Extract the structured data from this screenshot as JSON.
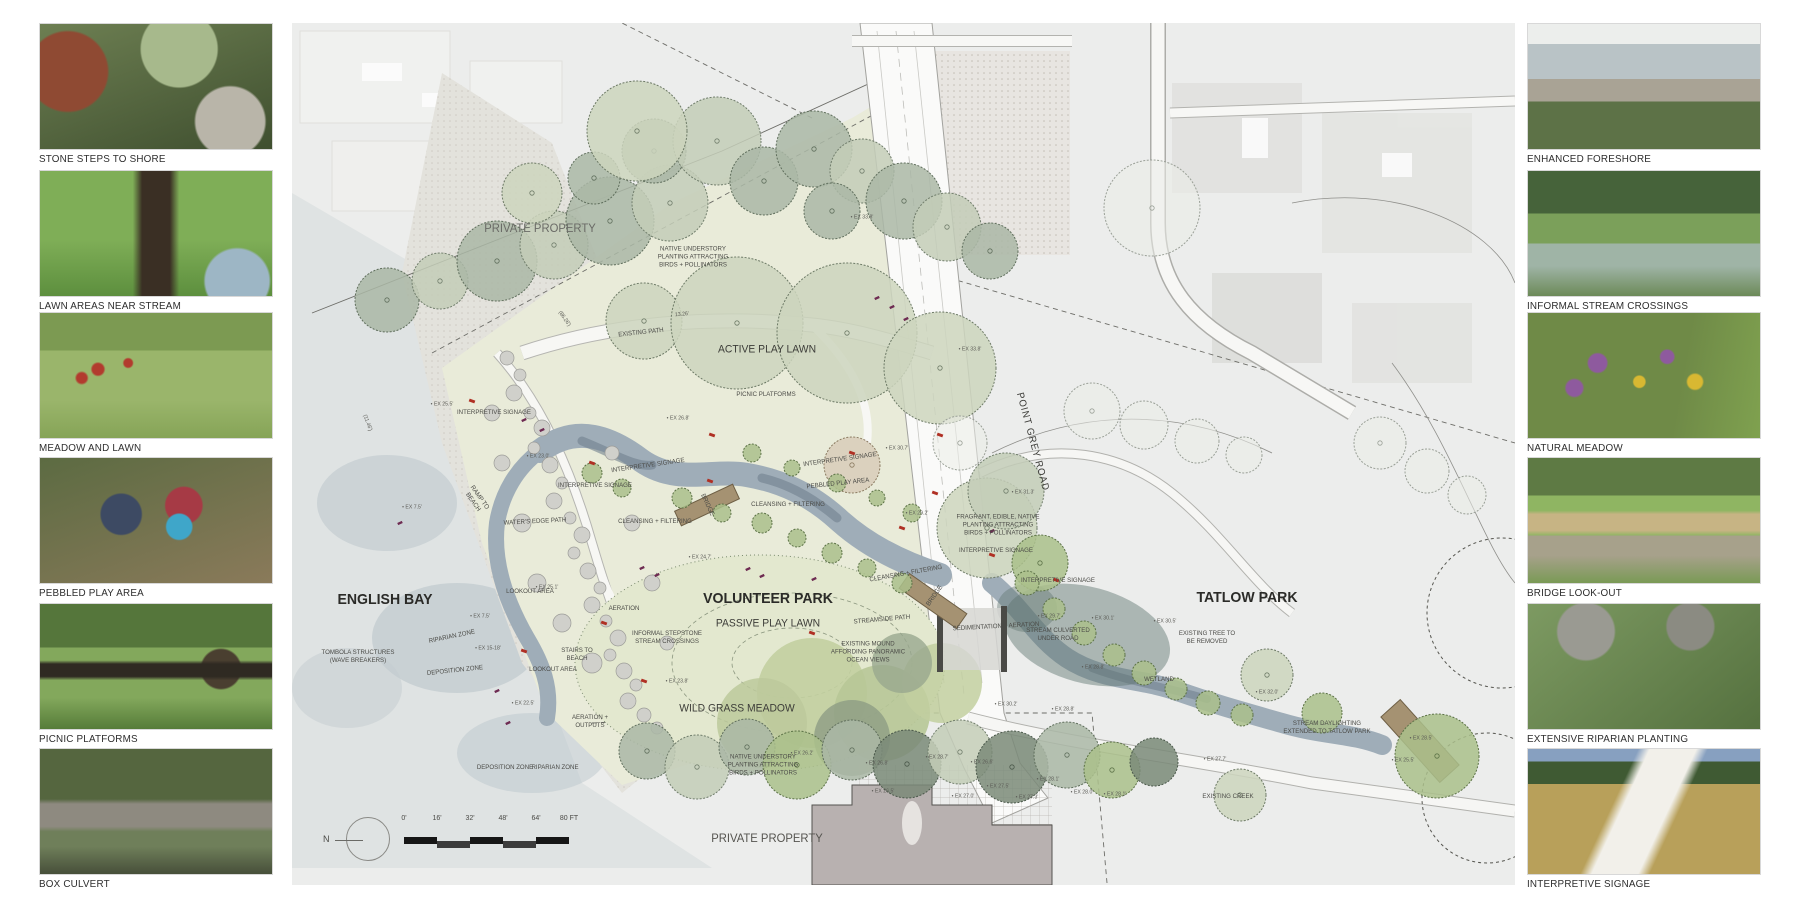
{
  "board_title": "Volunteer Park + Tatlow Park landscape plan board",
  "left_photos": [
    {
      "caption": "STONE STEPS TO SHORE"
    },
    {
      "caption": "LAWN AREAS NEAR STREAM"
    },
    {
      "caption": "MEADOW AND LAWN"
    },
    {
      "caption": "PEBBLED PLAY AREA"
    },
    {
      "caption": "PICNIC PLATFORMS"
    },
    {
      "caption": "BOX CULVERT"
    }
  ],
  "right_photos": [
    {
      "caption": "ENHANCED FORESHORE"
    },
    {
      "caption": "INFORMAL STREAM CROSSINGS"
    },
    {
      "caption": "NATURAL MEADOW"
    },
    {
      "caption": "BRIDGE LOOK-OUT"
    },
    {
      "caption": "EXTENSIVE RIPARIAN PLANTING"
    },
    {
      "caption": "INTERPRETIVE SIGNAGE"
    }
  ],
  "plan": {
    "scale": {
      "north_label": "N",
      "ticks": [
        "0'",
        "16'",
        "32'",
        "48'",
        "64'",
        "80 FT"
      ]
    },
    "region_labels": [
      {
        "t": "ENGLISH BAY",
        "x": 93,
        "y": 577,
        "s": 15,
        "w": 700,
        "c": "#2b2b28"
      },
      {
        "t": "VOLUNTEER PARK",
        "x": 476,
        "y": 576,
        "s": 15,
        "w": 700,
        "c": "#2b2b28"
      },
      {
        "t": "TATLOW PARK",
        "x": 955,
        "y": 575,
        "s": 15,
        "w": 700,
        "c": "#2b2b28"
      },
      {
        "t": "PRIVATE PROPERTY",
        "x": 248,
        "y": 205,
        "s": 12,
        "w": 400,
        "c": "#6a6a66"
      },
      {
        "t": "PRIVATE PROPERTY",
        "x": 475,
        "y": 815,
        "s": 12,
        "w": 400,
        "c": "#55544f"
      },
      {
        "t": "ACTIVE PLAY LAWN",
        "x": 475,
        "y": 327,
        "s": 11,
        "w": 400,
        "c": "#3c3c38"
      },
      {
        "t": "PASSIVE PLAY LAWN",
        "x": 476,
        "y": 601,
        "s": 11,
        "w": 400,
        "c": "#3c3c38"
      },
      {
        "t": "WILD GRASS MEADOW",
        "x": 445,
        "y": 686,
        "s": 11,
        "w": 400,
        "c": "#3c3c38"
      },
      {
        "t": "POINT GREY ROAD",
        "x": 740,
        "y": 419,
        "s": 10,
        "w": 400,
        "r": 75,
        "c": "#3c3c38",
        "ls": 1
      },
      {
        "t": "NATIVE UNDERSTORY\nPLANTING ATTRACTING\nBIRDS + POLLINATORS",
        "x": 401,
        "y": 234,
        "s": 6.5
      },
      {
        "t": "NATIVE UNDERSTORY\nPLANTING ATTRACTING\nBIRDS + POLLINATORS",
        "x": 471,
        "y": 742,
        "s": 6.5
      },
      {
        "t": "EXISTING PATH",
        "x": 349,
        "y": 310,
        "s": 6.5,
        "r": -6
      },
      {
        "t": "PICNIC PLATFORMS",
        "x": 474,
        "y": 372,
        "s": 6.5
      },
      {
        "t": "INTERPRETIVE SIGNAGE",
        "x": 202,
        "y": 390,
        "s": 6.5
      },
      {
        "t": "INTERPRETIVE SIGNAGE",
        "x": 303,
        "y": 463,
        "s": 6.5
      },
      {
        "t": "INTERPRETIVE SIGNAGE",
        "x": 356,
        "y": 443,
        "s": 6.5,
        "r": -8
      },
      {
        "t": "INTERPRETIVE SIGNAGE",
        "x": 548,
        "y": 437,
        "s": 6.5,
        "r": -8
      },
      {
        "t": "INTERPRETIVE SIGNAGE",
        "x": 704,
        "y": 528,
        "s": 6.5
      },
      {
        "t": "INTERPRETIVE SIGNAGE",
        "x": 766,
        "y": 558,
        "s": 6.5
      },
      {
        "t": "PEBBLED PLAY AREA",
        "x": 546,
        "y": 461,
        "s": 6.5,
        "r": -6
      },
      {
        "t": "BRIDGE",
        "x": 415,
        "y": 482,
        "s": 6.5,
        "r": 65
      },
      {
        "t": "BRIDGE",
        "x": 643,
        "y": 573,
        "s": 6.5,
        "r": -55
      },
      {
        "t": "CLEANSING + FILTERING",
        "x": 496,
        "y": 482,
        "s": 6.5
      },
      {
        "t": "CLEANSING + FILTERING",
        "x": 363,
        "y": 499,
        "s": 6.5
      },
      {
        "t": "CLEANSING + FILTERING",
        "x": 614,
        "y": 551,
        "s": 6.5,
        "r": -10
      },
      {
        "t": "WATER'S EDGE PATH",
        "x": 243,
        "y": 499,
        "s": 6.5,
        "r": -3
      },
      {
        "t": "RAMP TO\nBEACH",
        "x": 184,
        "y": 477,
        "s": 6.5,
        "r": 55
      },
      {
        "t": "LOOKOUT AREA",
        "x": 238,
        "y": 569,
        "s": 6.5
      },
      {
        "t": "LOOKOUT AREA",
        "x": 261,
        "y": 647,
        "s": 6.5
      },
      {
        "t": "AERATION",
        "x": 332,
        "y": 586,
        "s": 6.5
      },
      {
        "t": "AERATION +\nOUTPUTS",
        "x": 298,
        "y": 699,
        "s": 6.5
      },
      {
        "t": "TOMBOLA STRUCTURES\n(WAVE BREAKERS)",
        "x": 66,
        "y": 634,
        "s": 6.5
      },
      {
        "t": "RIPARIAN ZONE",
        "x": 160,
        "y": 614,
        "s": 6.5,
        "r": -12
      },
      {
        "t": "RIPARIAN ZONE",
        "x": 263,
        "y": 745,
        "s": 6.5
      },
      {
        "t": "DEPOSITION ZONE",
        "x": 163,
        "y": 648,
        "s": 6.5,
        "r": -6
      },
      {
        "t": "DEPOSITION ZONE",
        "x": 213,
        "y": 745,
        "s": 6.5
      },
      {
        "t": "STAIRS TO\nBEACH",
        "x": 285,
        "y": 632,
        "s": 6.5
      },
      {
        "t": "INFORMAL STEPSTONE\nSTREAM CROSSINGS",
        "x": 375,
        "y": 615,
        "s": 6.5
      },
      {
        "t": "STREAMSIDE PATH",
        "x": 590,
        "y": 597,
        "s": 6.5,
        "r": -5
      },
      {
        "t": "EXISTING MOUND\nAFFORDING PANORAMIC\nOCEAN VIEWS",
        "x": 576,
        "y": 629,
        "s": 6.5
      },
      {
        "t": "SEDIMENTATION + AERATION",
        "x": 704,
        "y": 604,
        "s": 6.5,
        "r": -3
      },
      {
        "t": "FRAGRANT, EDIBLE, NATIVE\nPLANTING ATTRACTING\nBIRDS + POLLINATORS",
        "x": 706,
        "y": 502,
        "s": 6.5
      },
      {
        "t": "STREAM CULVERTED\nUNDER ROAD",
        "x": 766,
        "y": 612,
        "s": 6.5
      },
      {
        "t": "WETLAND",
        "x": 867,
        "y": 657,
        "s": 6.5
      },
      {
        "t": "EXISTING TREE TO\nBE REMOVED",
        "x": 915,
        "y": 615,
        "s": 6.5
      },
      {
        "t": "STREAM DAYLIGHTING\nEXTENDED TO TATLOW PARK",
        "x": 1035,
        "y": 705,
        "s": 6.5
      },
      {
        "t": "EXISTING CREEK",
        "x": 936,
        "y": 774,
        "s": 6.5
      }
    ],
    "elevation_labels": [
      {
        "t": "• EX 33.8'",
        "x": 570,
        "y": 195
      },
      {
        "t": "• EX 33.8'",
        "x": 678,
        "y": 327
      },
      {
        "t": "• EX 26.8'",
        "x": 386,
        "y": 396
      },
      {
        "t": "• EX 30.7'",
        "x": 605,
        "y": 426
      },
      {
        "t": "• EX 29.2'",
        "x": 625,
        "y": 491
      },
      {
        "t": "• EX 31.3'",
        "x": 731,
        "y": 470
      },
      {
        "t": "• EX 30.1'",
        "x": 811,
        "y": 596
      },
      {
        "t": "• EX 29.7'",
        "x": 757,
        "y": 594
      },
      {
        "t": "• EX 28.8'",
        "x": 801,
        "y": 645
      },
      {
        "t": "• EX 28.8'",
        "x": 771,
        "y": 687
      },
      {
        "t": "• EX 30.2'",
        "x": 714,
        "y": 682
      },
      {
        "t": "• EX 30.5'",
        "x": 873,
        "y": 599
      },
      {
        "t": "• EX 32.0'",
        "x": 975,
        "y": 670
      },
      {
        "t": "• EX 27.7'",
        "x": 923,
        "y": 737
      },
      {
        "t": "• EX 28.1'",
        "x": 823,
        "y": 772
      },
      {
        "t": "• EX 25.1'",
        "x": 255,
        "y": 565
      },
      {
        "t": "• EX 23.0'",
        "x": 246,
        "y": 434
      },
      {
        "t": "• EX 25.5'",
        "x": 150,
        "y": 382
      },
      {
        "t": "• EX 7.5'",
        "x": 120,
        "y": 485
      },
      {
        "t": "• EX 7.5'",
        "x": 188,
        "y": 594
      },
      {
        "t": "• EX 23.8'",
        "x": 385,
        "y": 659
      },
      {
        "t": "• EX 24.7'",
        "x": 408,
        "y": 535
      },
      {
        "t": "• EX 22.5'",
        "x": 231,
        "y": 681
      },
      {
        "t": "• EX 15-18'",
        "x": 196,
        "y": 626
      },
      {
        "t": "• EX 26.2'",
        "x": 510,
        "y": 731
      },
      {
        "t": "• EX 26.8'",
        "x": 585,
        "y": 741
      },
      {
        "t": "• EX 26.5'",
        "x": 591,
        "y": 769
      },
      {
        "t": "• EX 28.7'",
        "x": 645,
        "y": 735
      },
      {
        "t": "• EX 26.6'",
        "x": 690,
        "y": 740
      },
      {
        "t": "• EX 27.0'",
        "x": 671,
        "y": 774
      },
      {
        "t": "• EX 27.5'",
        "x": 706,
        "y": 764
      },
      {
        "t": "• EX 27.3'",
        "x": 735,
        "y": 775
      },
      {
        "t": "• EX 28.1'",
        "x": 756,
        "y": 757
      },
      {
        "t": "• EX 28.0'",
        "x": 790,
        "y": 770
      },
      {
        "t": "• EX 28.5'",
        "x": 1129,
        "y": 716
      },
      {
        "t": "• EX 25.5'",
        "x": 1111,
        "y": 738
      }
    ],
    "dimension_labels": [
      {
        "t": "(86.26')",
        "x": 272,
        "y": 296,
        "r": 55
      },
      {
        "t": "13.26'",
        "x": 390,
        "y": 292,
        "r": -5
      },
      {
        "t": "(11.46')",
        "x": 75,
        "y": 400,
        "r": 70
      }
    ],
    "trees": [
      [
        95,
        277,
        32,
        "s"
      ],
      [
        148,
        258,
        28,
        "l"
      ],
      [
        205,
        238,
        40,
        "s"
      ],
      [
        262,
        222,
        34,
        "l"
      ],
      [
        318,
        198,
        44,
        "s"
      ],
      [
        378,
        180,
        38,
        "l"
      ],
      [
        302,
        155,
        26,
        "s"
      ],
      [
        362,
        128,
        32,
        "s"
      ],
      [
        425,
        118,
        44,
        "l"
      ],
      [
        472,
        158,
        34,
        "s"
      ],
      [
        522,
        126,
        38,
        "s"
      ],
      [
        570,
        148,
        32,
        "l"
      ],
      [
        612,
        178,
        38,
        "s"
      ],
      [
        655,
        204,
        34,
        "l"
      ],
      [
        698,
        228,
        28,
        "s"
      ],
      [
        540,
        188,
        28,
        "s"
      ],
      [
        345,
        108,
        50,
        "p"
      ],
      [
        240,
        170,
        30,
        "p"
      ],
      [
        352,
        298,
        38,
        "p"
      ],
      [
        445,
        300,
        66,
        "p"
      ],
      [
        555,
        310,
        70,
        "p"
      ],
      [
        648,
        345,
        56,
        "p"
      ],
      [
        668,
        420,
        27,
        "f"
      ],
      [
        860,
        185,
        48,
        "f"
      ],
      [
        800,
        388,
        28,
        "f"
      ],
      [
        852,
        402,
        24,
        "f"
      ],
      [
        905,
        418,
        22,
        "f"
      ],
      [
        952,
        432,
        18,
        "f"
      ],
      [
        1088,
        420,
        26,
        "f"
      ],
      [
        1135,
        448,
        22,
        "f"
      ],
      [
        1175,
        472,
        19,
        "f"
      ],
      [
        695,
        505,
        50,
        "p"
      ],
      [
        714,
        468,
        38,
        "l"
      ],
      [
        748,
        540,
        28,
        "g"
      ],
      [
        975,
        652,
        26,
        "p"
      ],
      [
        948,
        772,
        26,
        "p"
      ],
      [
        1145,
        733,
        42,
        "g"
      ],
      [
        1030,
        690,
        20,
        "g"
      ],
      [
        560,
        442,
        28,
        "b"
      ],
      [
        735,
        560,
        12,
        "g"
      ],
      [
        762,
        586,
        11,
        "g"
      ],
      [
        792,
        610,
        12,
        "g"
      ],
      [
        822,
        632,
        11,
        "g"
      ],
      [
        852,
        650,
        12,
        "g"
      ],
      [
        884,
        666,
        11,
        "g"
      ],
      [
        916,
        680,
        12,
        "g"
      ],
      [
        950,
        692,
        11,
        "g"
      ],
      [
        355,
        728,
        28,
        "s"
      ],
      [
        405,
        744,
        32,
        "l"
      ],
      [
        455,
        724,
        28,
        "s"
      ],
      [
        505,
        742,
        34,
        "g"
      ],
      [
        560,
        727,
        30,
        "s"
      ],
      [
        615,
        741,
        34,
        "d"
      ],
      [
        668,
        729,
        32,
        "l"
      ],
      [
        720,
        744,
        36,
        "d"
      ],
      [
        775,
        732,
        33,
        "s"
      ],
      [
        820,
        747,
        28,
        "g"
      ],
      [
        862,
        739,
        24,
        "d"
      ],
      [
        300,
        450,
        10,
        "g"
      ],
      [
        330,
        465,
        9,
        "g"
      ],
      [
        390,
        475,
        10,
        "g"
      ],
      [
        430,
        490,
        9,
        "g"
      ],
      [
        470,
        500,
        10,
        "g"
      ],
      [
        505,
        515,
        9,
        "g"
      ],
      [
        540,
        530,
        10,
        "g"
      ],
      [
        575,
        545,
        9,
        "g"
      ],
      [
        610,
        560,
        10,
        "g"
      ],
      [
        460,
        430,
        9,
        "g"
      ],
      [
        500,
        445,
        8,
        "g"
      ],
      [
        545,
        460,
        9,
        "g"
      ],
      [
        585,
        475,
        8,
        "g"
      ],
      [
        620,
        490,
        9,
        "g"
      ]
    ],
    "pebbles": [
      [
        215,
        335,
        7
      ],
      [
        228,
        352,
        6
      ],
      [
        222,
        370,
        8
      ],
      [
        238,
        390,
        6
      ],
      [
        250,
        405,
        8
      ],
      [
        242,
        425,
        6
      ],
      [
        258,
        442,
        8
      ],
      [
        270,
        460,
        6
      ],
      [
        262,
        478,
        8
      ],
      [
        278,
        495,
        6
      ],
      [
        290,
        512,
        8
      ],
      [
        282,
        530,
        6
      ],
      [
        296,
        548,
        8
      ],
      [
        308,
        565,
        6
      ],
      [
        300,
        582,
        8
      ],
      [
        314,
        598,
        6
      ],
      [
        326,
        615,
        8
      ],
      [
        318,
        632,
        6
      ],
      [
        332,
        648,
        8
      ],
      [
        344,
        662,
        6
      ],
      [
        336,
        678,
        8
      ],
      [
        352,
        692,
        7
      ],
      [
        365,
        705,
        6
      ],
      [
        300,
        640,
        10
      ],
      [
        270,
        600,
        9
      ],
      [
        245,
        560,
        9
      ],
      [
        230,
        500,
        9
      ],
      [
        210,
        440,
        8
      ],
      [
        200,
        390,
        8
      ],
      [
        320,
        430,
        7
      ],
      [
        340,
        500,
        8
      ],
      [
        360,
        560,
        8
      ],
      [
        375,
        620,
        7
      ]
    ],
    "red_marks": [
      [
        180,
        378
      ],
      [
        420,
        412
      ],
      [
        300,
        440
      ],
      [
        560,
        430
      ],
      [
        643,
        470
      ],
      [
        700,
        532
      ],
      [
        764,
        557
      ],
      [
        312,
        600
      ],
      [
        352,
        658
      ],
      [
        232,
        628
      ],
      [
        418,
        458
      ],
      [
        610,
        505
      ],
      [
        648,
        412
      ],
      [
        520,
        610
      ]
    ],
    "purple_marks": [
      [
        585,
        275
      ],
      [
        600,
        284
      ],
      [
        614,
        296
      ],
      [
        232,
        397
      ],
      [
        250,
        407
      ],
      [
        456,
        546
      ],
      [
        470,
        553
      ],
      [
        108,
        500
      ],
      [
        216,
        700
      ],
      [
        522,
        556
      ],
      [
        700,
        508
      ],
      [
        350,
        545
      ],
      [
        365,
        552
      ],
      [
        205,
        668
      ]
    ]
  },
  "colors": {
    "plan_bg": "#ecedec",
    "water": "#dfe3e3",
    "deep_water": "#bcc7cc",
    "sand": "#e3e2dc",
    "park": "#e9ebd9",
    "lawn": "#ccd8a9",
    "meadow": "#c2cfa0",
    "stream": "#9fadb8",
    "pool": "#71808e",
    "wetland": "#5e746e",
    "road": "#fafaf9",
    "bridge": "#a59272",
    "sage_tree": "#aab7a6",
    "red_accent": "#b03024",
    "purple_accent": "#6e2b52",
    "building": "#b8b1b0"
  }
}
